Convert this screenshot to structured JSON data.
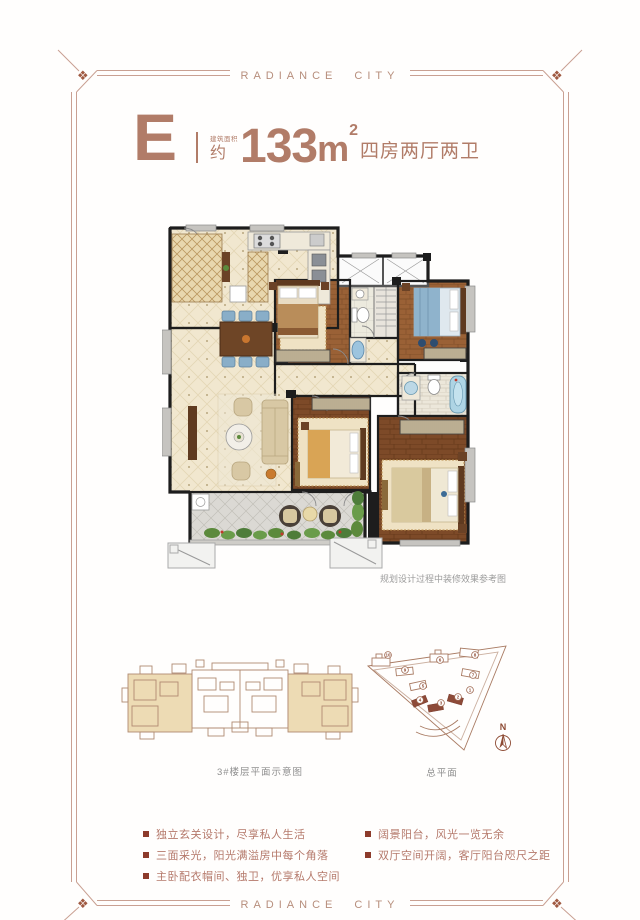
{
  "brand": {
    "title": "RADIANCE CITY"
  },
  "unit": {
    "letter": "E",
    "area_label": "建筑面积",
    "approx": "约",
    "area_value": "133",
    "area_unit": "m",
    "area_sup": "2",
    "layout": "四房两厅两卫"
  },
  "floor_plan": {
    "note": "规划设计过程中装修效果参考图"
  },
  "diagrams": {
    "floor_diagram_label": "3#楼层平面示意图",
    "site_plan_label": "总平面",
    "north_label": "N"
  },
  "site_plan": {
    "markers": [
      {
        "n": "10",
        "x": 28,
        "y": 13
      },
      {
        "n": "9",
        "x": 45,
        "y": 28
      },
      {
        "n": "6",
        "x": 80,
        "y": 18
      },
      {
        "n": "8",
        "x": 115,
        "y": 13
      },
      {
        "n": "7",
        "x": 113,
        "y": 33
      },
      {
        "n": "5",
        "x": 63,
        "y": 44
      },
      {
        "n": "4",
        "x": 60,
        "y": 58
      },
      {
        "n": "3",
        "x": 81,
        "y": 61
      },
      {
        "n": "2",
        "x": 98,
        "y": 55
      },
      {
        "n": "1",
        "x": 110,
        "y": 48
      }
    ]
  },
  "features": {
    "left": [
      "独立玄关设计，尽享私人生活",
      "三面采光，阳光满溢房中每个角落",
      "主卧配衣帽间、独卫，优享私人空间"
    ],
    "right": [
      "阔景阳台，风光一览无余",
      "双厅空间开阔，客厅阳台咫尺之距"
    ]
  },
  "colors": {
    "accent": "#b17c68",
    "frame": "#c9a092",
    "bullet": "#8d3b2b",
    "wall": "#1d1d1d",
    "wood": "#9a6136",
    "beige_floor": "#f1e7cf"
  }
}
